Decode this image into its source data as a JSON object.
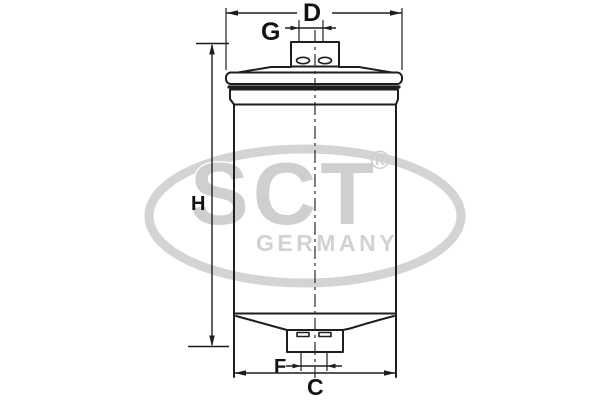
{
  "labels": {
    "d": "D",
    "g": "G",
    "h": "H",
    "f": "F",
    "c": "C"
  },
  "watermark": {
    "brand": "SCT",
    "registered": "®",
    "country": "GERMANY",
    "color": "#cfcfcf"
  },
  "colors": {
    "background": "#ffffff",
    "line": "#1e1e1e",
    "label": "#111111"
  }
}
